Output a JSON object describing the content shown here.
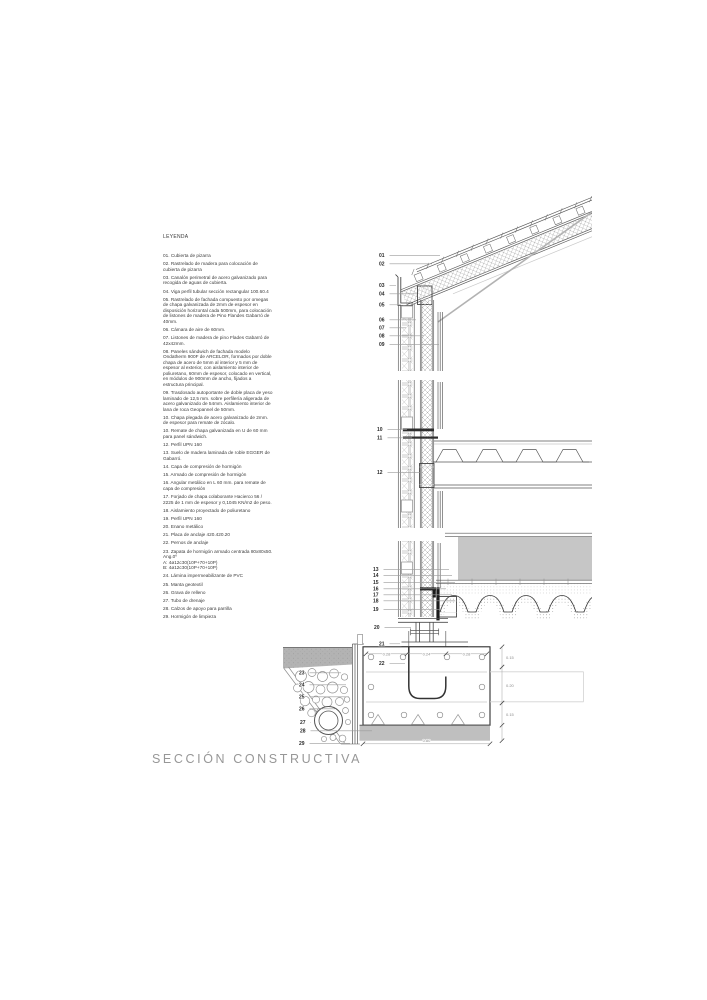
{
  "title": "SECCIÓN CONSTRUCTIVA",
  "legend": {
    "heading": "LEYENDA",
    "items": [
      {
        "num": "01",
        "text": "Cubierta de pizarra"
      },
      {
        "num": "02",
        "text": "Rastrelado de madera para colocación de cubierta de pizarra"
      },
      {
        "num": "03",
        "text": "Canalón perimetral de acero galvanizado para recogida de aguas de cubierta."
      },
      {
        "num": "04",
        "text": "Viga perfil tubular sección rectangular 100.60.4"
      },
      {
        "num": "05",
        "text": "Rastrelado de fachada compuesto por omegas de chapa galvanizada de 2mm de espesor en disposición horizontal cada 500mm, para colocación de listones de madera de Pino Flandes Gabarró de 40mm."
      },
      {
        "num": "06",
        "text": "Cámara de aire de 60mm."
      },
      {
        "num": "07",
        "text": "Listones de madera de pino Flades Gabarró de 42x42mm."
      },
      {
        "num": "08",
        "text": "Paneles sándwich de fachada modelo Ondatherm 900F de ARCELOR, formados por doble chapa de acero de 5mm al interior y 5 mm de espesor al exterior, con aislamiento interior de poliuretano, 60mm de espesor, colocado en vertical, en módulos de 900mm de ancho, fijados a estructura principal."
      },
      {
        "num": "09",
        "text": "Trasdosado autoportante de doble placa de yeso laminado de 12,5 mm. sobre perfilería aligerada de acero galvanizado de 54mm. Aislamiento interior de lana de roca Geopannel de 50mm."
      },
      {
        "num": "10",
        "text": "Chapa plegada de acero galvanizado de 2mm. de espesor para remate de zócalo."
      },
      {
        "num": "10",
        "text": "Remate de chapa galvanizada en U de 60 mm para panel sándwich."
      },
      {
        "num": "12",
        "text": "Perfil UPN 160"
      },
      {
        "num": "13",
        "text": "Suelo de madera laminada de roble EGGER de Gabarró."
      },
      {
        "num": "14",
        "text": "Capa de compresión de hormigón"
      },
      {
        "num": "15",
        "text": "Armado de compresión de hormigón"
      },
      {
        "num": "16",
        "text": "Angular metálico en L 60 mm. para remate de capa de compresión"
      },
      {
        "num": "17",
        "text": "Forjado de chapa colaborante Hacierco 56 / 2225 de 1 mm de espesor y 0,1045 KN/m2 de peso."
      },
      {
        "num": "18",
        "text": "Aislamiento proyectado de poliuretano"
      },
      {
        "num": "19",
        "text": "Perfil UPN 160"
      },
      {
        "num": "20",
        "text": "Enano metálico"
      },
      {
        "num": "21",
        "text": "Placa de anclaje 420.420.20"
      },
      {
        "num": "22",
        "text": "Pernos de anclaje"
      },
      {
        "num": "23",
        "text": "Zapata de hormigón armado centrada 80x80x50. Ang.0º\nA: 4ø12c30(10P+70+10P)\nB: 4ø12c30(10P+70+10P)"
      },
      {
        "num": "24",
        "text": "Lámina impermeabilizante de PVC"
      },
      {
        "num": "25",
        "text": "Manta geotextil"
      },
      {
        "num": "26",
        "text": "Grava de relleno"
      },
      {
        "num": "27",
        "text": "Tubo de drenaje"
      },
      {
        "num": "28",
        "text": "Calzos de apoyo para parrilla"
      },
      {
        "num": "29",
        "text": "Hormigón de limpieza"
      }
    ]
  },
  "drawing": {
    "callouts": [
      {
        "n": "01",
        "x": 379,
        "y": 257,
        "tx": 440
      },
      {
        "n": "02",
        "x": 379,
        "y": 265.5,
        "tx": 432
      },
      {
        "n": "03",
        "x": 379,
        "y": 287,
        "tx": 396
      },
      {
        "n": "04",
        "x": 379,
        "y": 295.5,
        "tx": 417
      },
      {
        "n": "05",
        "x": 379,
        "y": 306.5,
        "tx": 401
      },
      {
        "n": "06",
        "x": 379,
        "y": 321.5,
        "tx": 416
      },
      {
        "n": "07",
        "x": 379,
        "y": 329.5,
        "tx": 406
      },
      {
        "n": "08",
        "x": 379,
        "y": 337.5,
        "tx": 424
      },
      {
        "n": "09",
        "x": 379,
        "y": 346,
        "tx": 439
      },
      {
        "n": "10",
        "x": 377,
        "y": 431,
        "tx": 407
      },
      {
        "n": "11",
        "x": 377,
        "y": 439.5,
        "tx": 412
      },
      {
        "n": "12",
        "x": 377,
        "y": 474,
        "tx": 420
      },
      {
        "n": "13",
        "x": 373,
        "y": 571,
        "tx": 449
      },
      {
        "n": "14",
        "x": 373,
        "y": 577,
        "tx": 452
      },
      {
        "n": "15",
        "x": 373,
        "y": 584,
        "tx": 455
      },
      {
        "n": "16",
        "x": 373,
        "y": 590.5,
        "tx": 446
      },
      {
        "n": "17",
        "x": 373,
        "y": 596.5,
        "tx": 452
      },
      {
        "n": "18",
        "x": 373,
        "y": 602.5,
        "tx": 455
      },
      {
        "n": "19",
        "x": 373,
        "y": 611,
        "tx": 441
      },
      {
        "n": "20",
        "x": 374,
        "y": 629,
        "tx": 411
      },
      {
        "n": "21",
        "x": 379,
        "y": 645.5,
        "tx": 400
      },
      {
        "n": "22",
        "x": 379,
        "y": 665,
        "tx": 405
      },
      {
        "n": "23",
        "x": 299,
        "y": 674.5,
        "tx": 341
      },
      {
        "n": "24",
        "x": 299,
        "y": 686.5,
        "tx": 346
      },
      {
        "n": "25",
        "x": 299,
        "y": 698.5,
        "tx": 349
      },
      {
        "n": "26",
        "x": 299,
        "y": 710.5,
        "tx": 335
      },
      {
        "n": "27",
        "x": 300,
        "y": 724,
        "tx": 311
      },
      {
        "n": "28",
        "x": 300,
        "y": 732.5,
        "tx": 372
      },
      {
        "n": "29",
        "x": 299,
        "y": 745,
        "tx": 350
      }
    ],
    "dim_labels": [
      {
        "text": "0.28",
        "x": 386.5,
        "y": 655.6,
        "anchor": "middle"
      },
      {
        "text": "0.24",
        "x": 426.5,
        "y": 655.6,
        "anchor": "middle"
      },
      {
        "text": "0.28",
        "x": 466.5,
        "y": 655.6,
        "anchor": "middle"
      },
      {
        "text": "0.80",
        "x": 426.5,
        "y": 741.8,
        "anchor": "middle"
      },
      {
        "text": "0.15",
        "x": 506,
        "y": 659,
        "anchor": "start"
      },
      {
        "text": "0.20",
        "x": 506,
        "y": 687,
        "anchor": "start"
      },
      {
        "text": "0.15",
        "x": 506,
        "y": 716,
        "anchor": "start"
      }
    ]
  },
  "colors": {
    "line": "#565656",
    "dark": "#1c1c1c",
    "terrain": "#b3b3b3",
    "block": "#c6c6c6",
    "lean_concrete": "#bfbfbf",
    "title": "#979797"
  }
}
